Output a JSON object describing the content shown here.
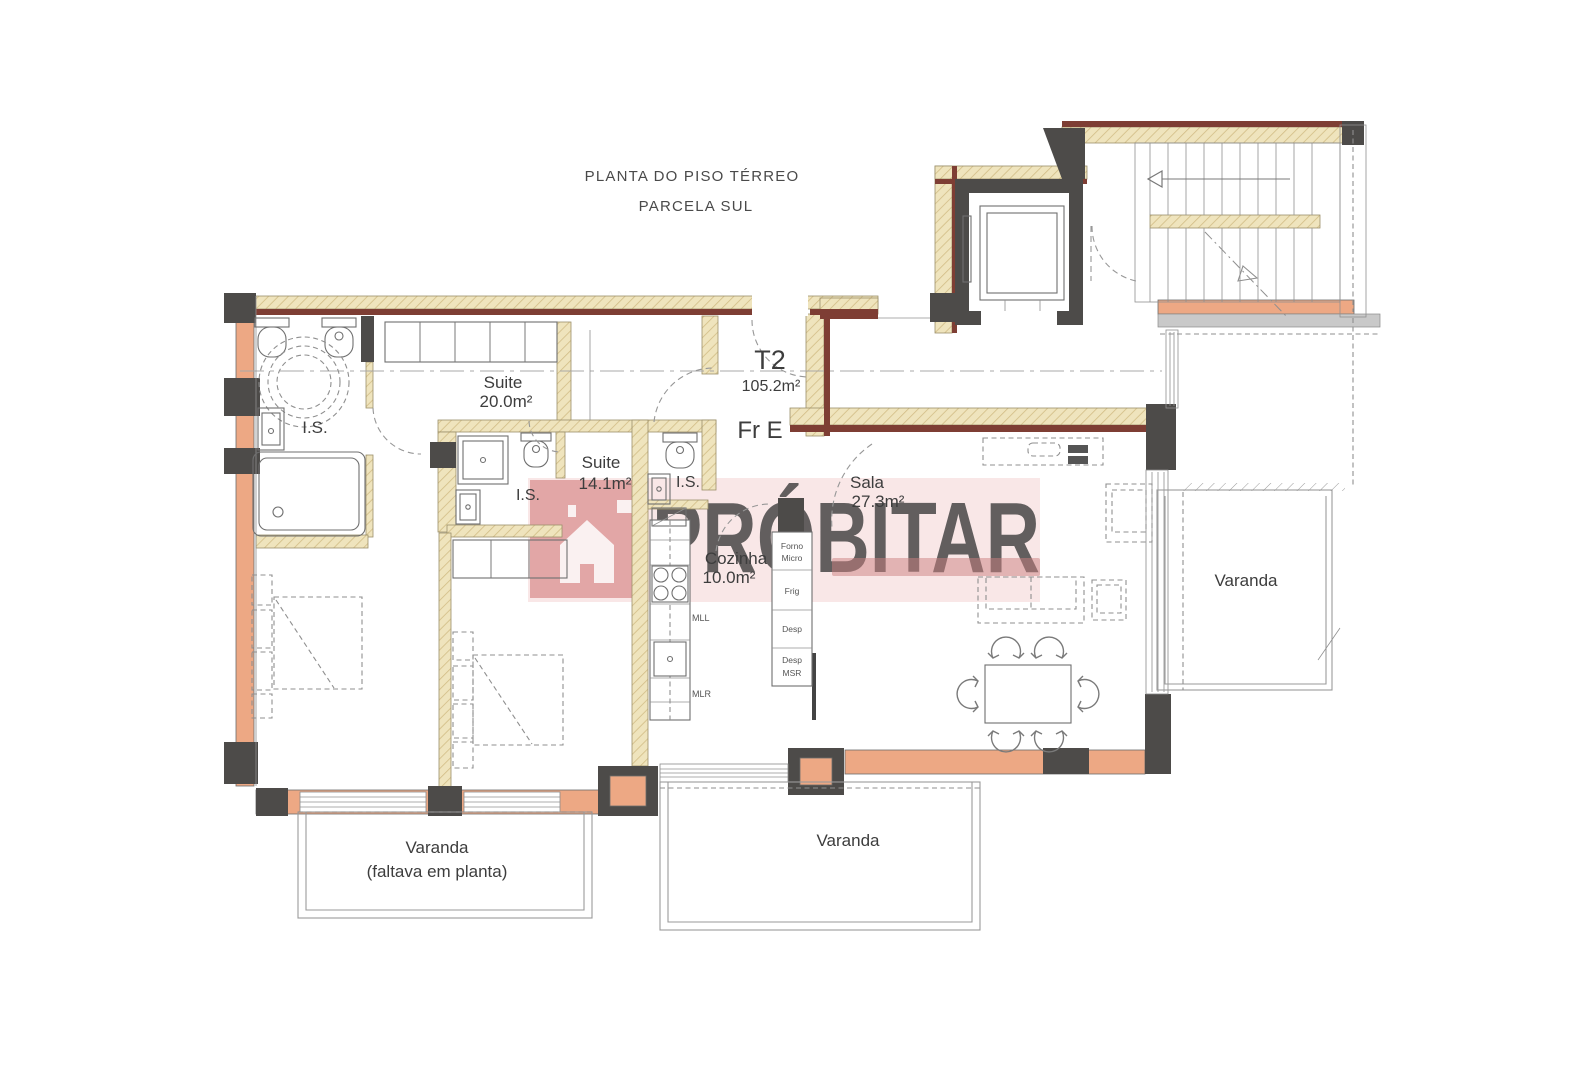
{
  "title": {
    "line1": "PLANTA DO PISO TÉRREO",
    "line2": "PARCELA SUL"
  },
  "unit": {
    "type": "T2",
    "area": "105.2m²",
    "entry_label": "Fr E"
  },
  "rooms": {
    "suite1": {
      "label": "Suite",
      "area": "20.0m²"
    },
    "suite2": {
      "label": "Suite",
      "area": "14.1m²"
    },
    "sala": {
      "label": "Sala",
      "area": "27.3m²"
    },
    "cozinha": {
      "label": "Cozinha",
      "area": "10.0m²"
    },
    "is1": {
      "label": "I.S."
    },
    "is2": {
      "label": "I.S."
    },
    "is3": {
      "label": "I.S."
    }
  },
  "balconies": {
    "left": {
      "line1": "Varanda",
      "line2": "(faltava em planta)"
    },
    "center": {
      "label": "Varanda"
    },
    "right": {
      "label": "Varanda"
    }
  },
  "kitchen": {
    "mll": "MLL",
    "mlr": "MLR",
    "appliances": {
      "oven_line1": "Forno",
      "oven_line2": "Micro",
      "fridge": "Frig",
      "pantry": "Desp",
      "pantry2_line1": "Desp",
      "pantry2_line2": "MSR"
    }
  },
  "watermark": {
    "brand": "PRÓBITAR"
  },
  "colors": {
    "wall_fill": "#efe4bd",
    "unit_boundary": "#7e3e34",
    "structure": "#4d4b49",
    "exterior_wall": "#eda884",
    "watermark": "#d98a8a"
  }
}
